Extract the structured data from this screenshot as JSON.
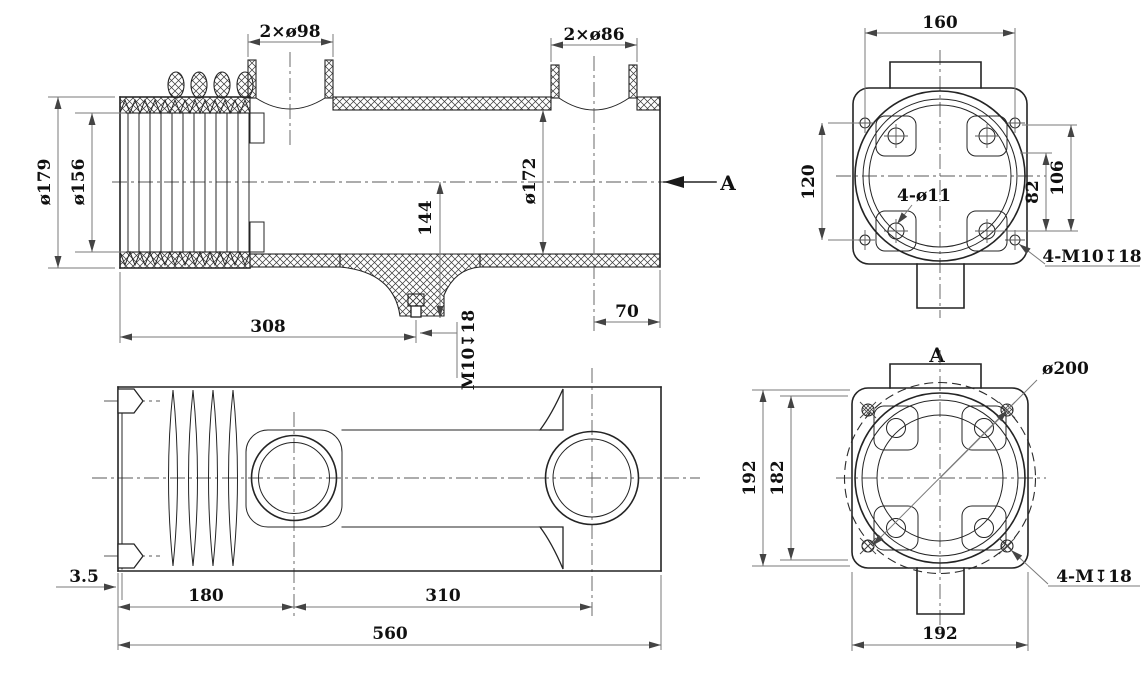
{
  "drawing": {
    "front_view": {
      "port1_dim": "2×ø98",
      "port2_dim": "2×ø86",
      "outer_dia": "ø179",
      "root_dia": "ø156",
      "bore_dia": "ø172",
      "drain_height": "144",
      "drain_position": "308",
      "end_offset": "70",
      "drain_thread": "M10↧18",
      "section_arrow_label": "A"
    },
    "flange_view": {
      "flange_width": "160",
      "hole_spacing_vertical": "120",
      "hole_spacing_inner": "82",
      "hole_spacing_outer": "106",
      "through_holes": "4-ø11",
      "tapped_holes": "4-M10↧18"
    },
    "section_view": {
      "title": "A",
      "bolt_circle_dia": "ø200",
      "outer_height": "192",
      "inner_height": "182",
      "width": "192",
      "tapped_holes": "4-M↧18"
    },
    "top_view": {
      "wall_thickness": "3.5",
      "bellows_length": "180",
      "port_spacing": "310",
      "total_length": "560"
    },
    "line_color": "#242424",
    "dim_color": "#7a7a7a",
    "background": "#ffffff"
  }
}
